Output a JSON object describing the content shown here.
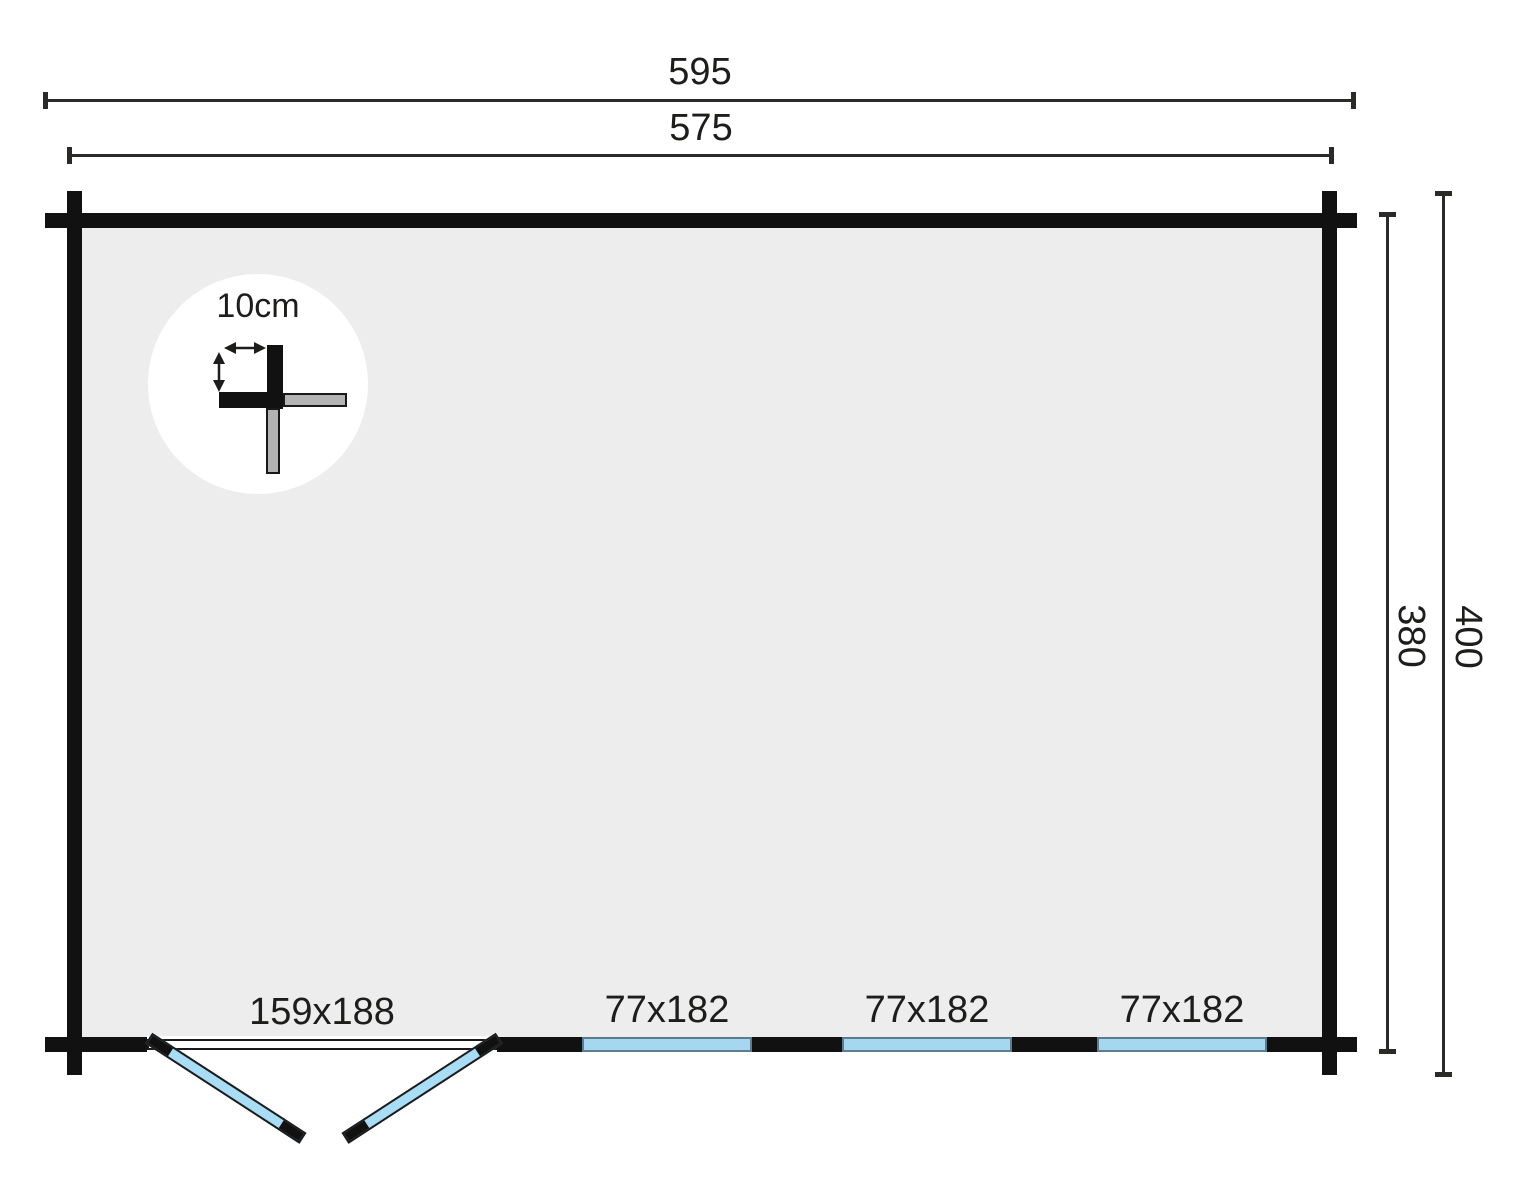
{
  "floorplan": {
    "dimensions": {
      "top_outer": "595",
      "top_inner": "575",
      "side_inner": "380",
      "side_outer": "400"
    },
    "wall_detail": {
      "thickness_label": "10cm"
    },
    "door": {
      "size_label": "159x188"
    },
    "windows": [
      {
        "size_label": "77x182"
      },
      {
        "size_label": "77x182"
      },
      {
        "size_label": "77x182"
      }
    ],
    "colors": {
      "background": "#ffffff",
      "wall": "#111111",
      "interior_floor": "#ededed",
      "dimension_line": "#2a2a28",
      "window_glass": "#a5d7f0",
      "window_frame": "#5d7d8e",
      "door_glass": "#a9dcf5",
      "detail_log_gray": "#b3b3b3"
    }
  }
}
